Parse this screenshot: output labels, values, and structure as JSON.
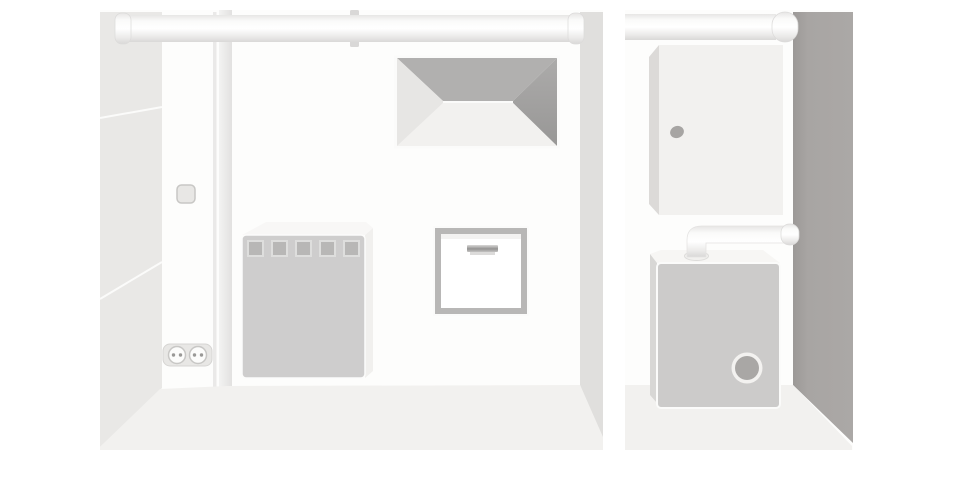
{
  "scene": {
    "description": "Two-panel grayscale vector illustration of basement utility rooms",
    "panels": [
      {
        "id": "laundry-room",
        "objects": [
          "ceiling-pipe",
          "pipe-bracket",
          "angled-side-wall",
          "wall-switch",
          "recessed-wall-vent",
          "vented-appliance-cabinet",
          "wall-access-panel",
          "double-power-outlet",
          "floor"
        ]
      },
      {
        "id": "boiler-room",
        "objects": [
          "ceiling-pipe",
          "wall-fuse-cabinet",
          "cabinet-knob",
          "boiler",
          "boiler-flue-pipe",
          "boiler-burner-port",
          "dark-side-wall",
          "floor"
        ]
      }
    ]
  },
  "colors": {
    "background": "#ffffff",
    "wall-white": "#fdfdfc",
    "wall-left": "#e9e8e6",
    "wall-sliver": "#e0dfdd",
    "wall-dark": "#a8a5a3",
    "floor": "#f2f1ef",
    "pipe-highlight": "#ffffff",
    "pipe-shade": "#d9d8d7",
    "vent-top": "#b1b0af",
    "vent-right": "#a2a1a0",
    "vent-bottom": "#f2f1ef",
    "vent-left": "#e7e6e4",
    "appliance-front": "#cecdcd",
    "appliance-top": "#f8f7f6",
    "appliance-vent-square": "#b8b7b6",
    "panel-frame": "#b8b7b6",
    "panel-inner": "#ffffff",
    "boiler-front": "#cccbca",
    "boiler-top": "#f7f6f4",
    "boiler-side": "#d8d7d5",
    "boiler-port": "#a9a7a5",
    "cabinet-front": "#f2f1ef",
    "cabinet-side": "#dcdad8",
    "knob": "#a7a5a3",
    "outlet-plate": "#e8e7e5",
    "outlet-hole": "#9a9997",
    "switch-fill": "#e8e7e5",
    "switch-border": "#c8c7c5"
  }
}
